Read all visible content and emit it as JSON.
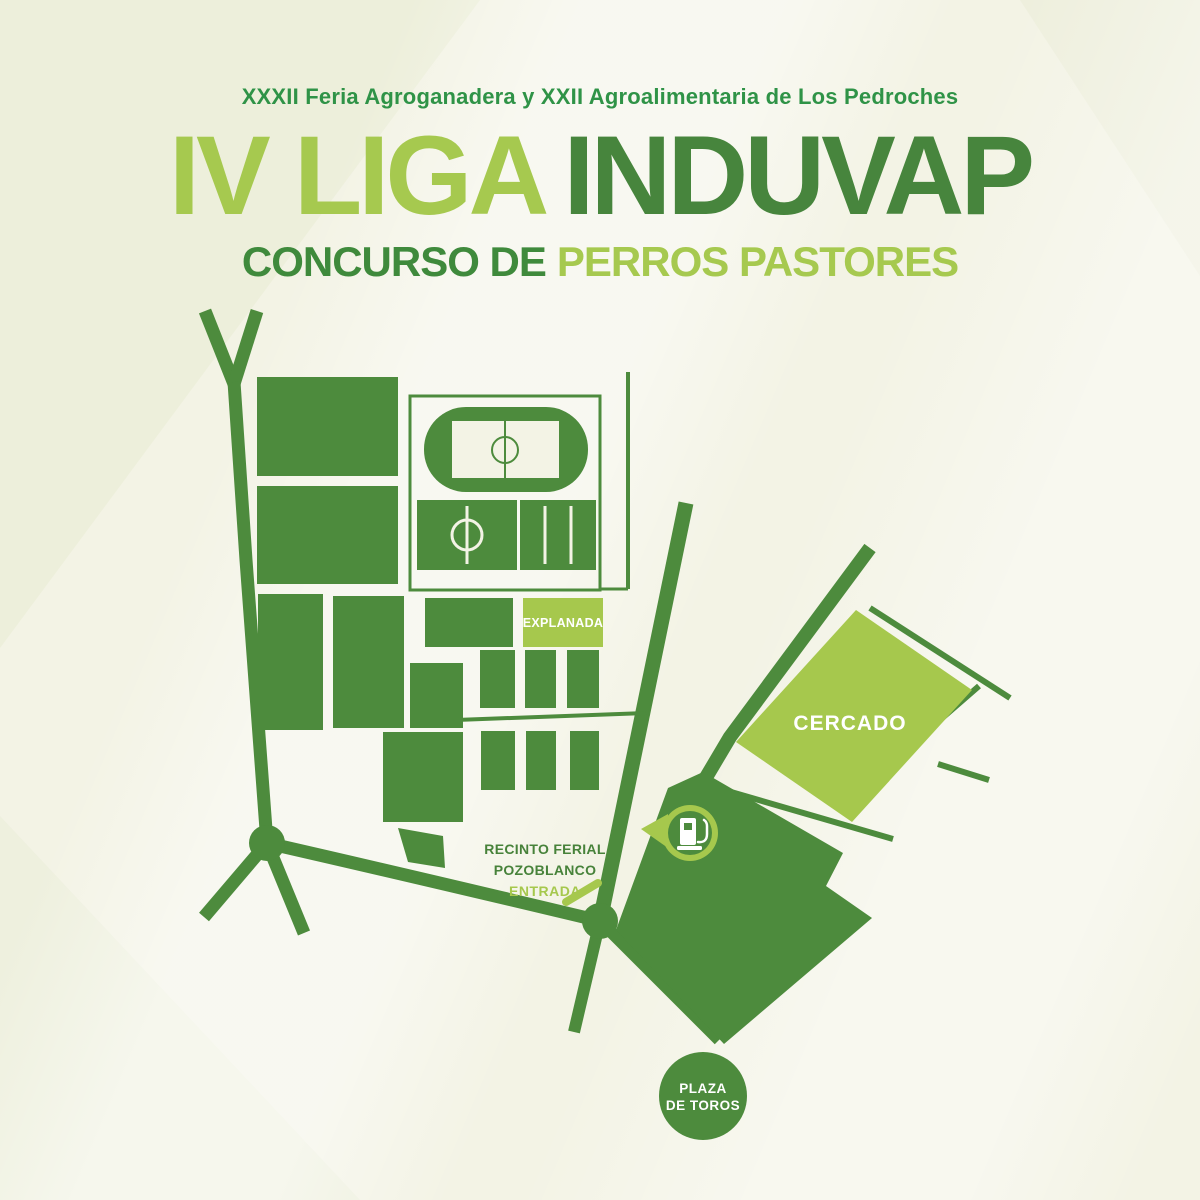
{
  "poster": {
    "subtitle": "XXXII Feria Agroganadera y XXII Agroalimentaria de Los Pedroches",
    "title_light": "IV LIGA",
    "title_dark": "INDUVAP",
    "tagline_dark": "CONCURSO DE",
    "tagline_light": "PERROS PASTORES"
  },
  "map": {
    "labels": {
      "explanada": "EXPLANADA",
      "cercado": "CERCADO",
      "recinto_line1": "RECINTO FERIAL",
      "recinto_line2": "POZOBLANCO",
      "entrada": "ENTRADA",
      "plaza_line1": "PLAZA",
      "plaza_line2": "DE TOROS"
    },
    "icons": {
      "fuel_pump": "fuel-pump-icon"
    }
  },
  "colors": {
    "dark_green": "#4d8b3d",
    "light_green": "#a6c84d",
    "subtitle_green": "#2f9347",
    "title_dark_green": "#47853d",
    "title_light_green": "#a6c94f",
    "background": "#f3f3e5",
    "background_band": "#e9ecd6",
    "label_white": "#ffffff"
  }
}
